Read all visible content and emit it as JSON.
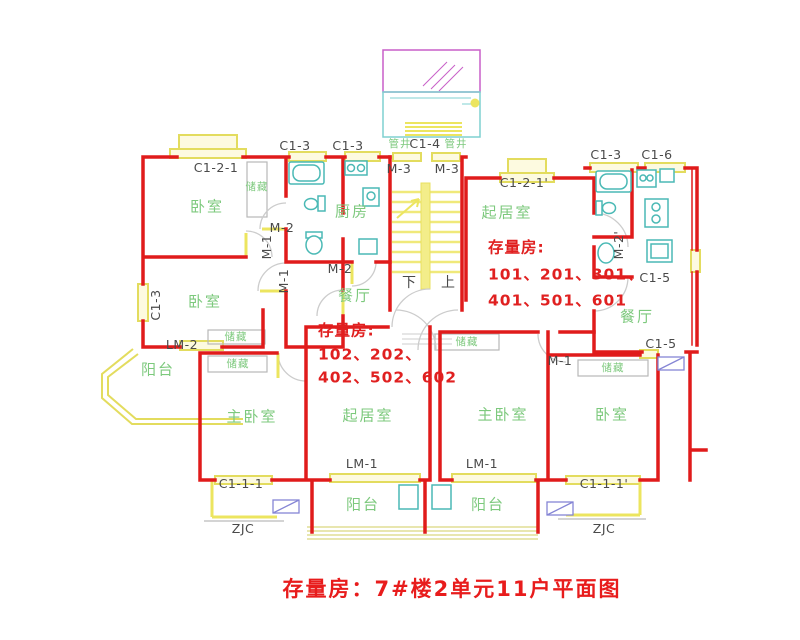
{
  "title": "存量房：7#楼2单元11户平面图",
  "notes": {
    "unit1": [
      "存量房:",
      "101、201、301、",
      "401、501、601"
    ],
    "unit2": [
      "存量房:",
      "102、202、",
      "402、502、602"
    ]
  },
  "rooms": {
    "bedroom": "卧室",
    "master_bedroom": "主卧室",
    "living": "起居室",
    "kitchen": "厨房",
    "dining": "餐厅",
    "balcony": "阳台",
    "storage": "储藏",
    "shaft": "管井"
  },
  "tags": {
    "c1_1_1": "C1-1-1",
    "c1_1_1p": "C1-1-1'",
    "c1_2_1": "C1-2-1",
    "c1_2_1p": "C1-2-1'",
    "c1_3": "C1-3",
    "c1_4": "C1-4",
    "c1_5": "C1-5",
    "c1_6": "C1-6",
    "m1": "M-1",
    "m2": "M-2",
    "m2p": "M-2'",
    "m3": "M-3",
    "lm1": "LM-1",
    "lm2": "LM-2",
    "zjc": "ZJC",
    "down": "下",
    "up": "上"
  },
  "colors": {
    "wall": "#e01b1b",
    "window": "#e3dc5e",
    "fixture": "#4ab9b5",
    "room_text": "#7dc97d",
    "tag_text": "#4a4a4a",
    "note_text": "#e02020",
    "canopy": "#c85fc8"
  }
}
